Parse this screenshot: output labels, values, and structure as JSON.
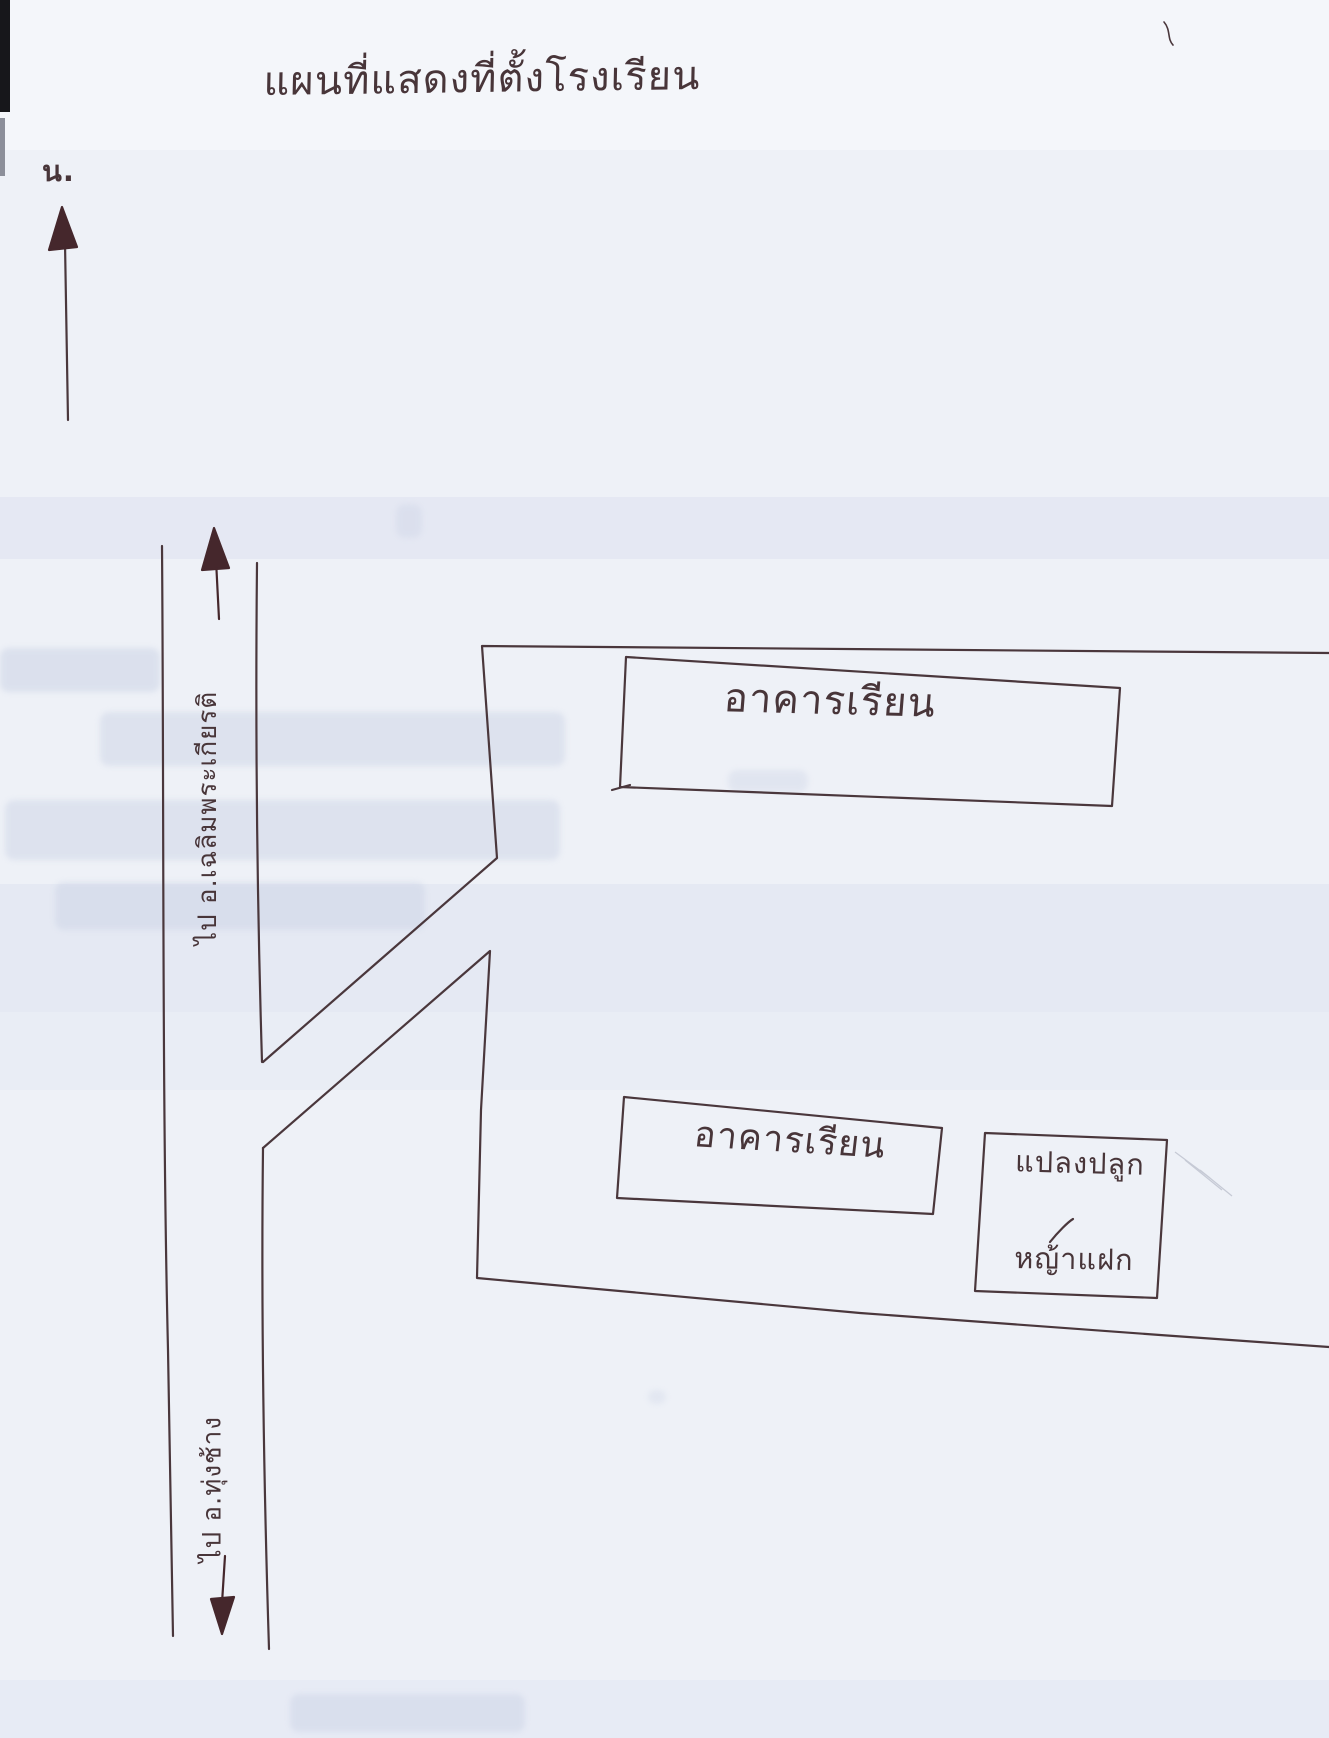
{
  "page": {
    "title": "แผนที่แสดงที่ตั้งโรงเรียน",
    "compass": {
      "north_label": "น."
    },
    "road": {
      "north_destination": "ไป อ.เฉลิมพระเกียรติ",
      "south_destination": "ไป อ.ทุ่งช้าง"
    },
    "areas": {
      "building_upper_label": "อาคารเรียน",
      "building_lower_label": "อาคารเรียน",
      "plot_label_line1": "แปลงปลูก",
      "plot_label_line2": "หญ้าแฝก"
    },
    "colors": {
      "ink": "#4a373c",
      "arrow_ink": "#45272c",
      "paper": "#eef1f7",
      "pencil": "#b6bac8"
    }
  }
}
